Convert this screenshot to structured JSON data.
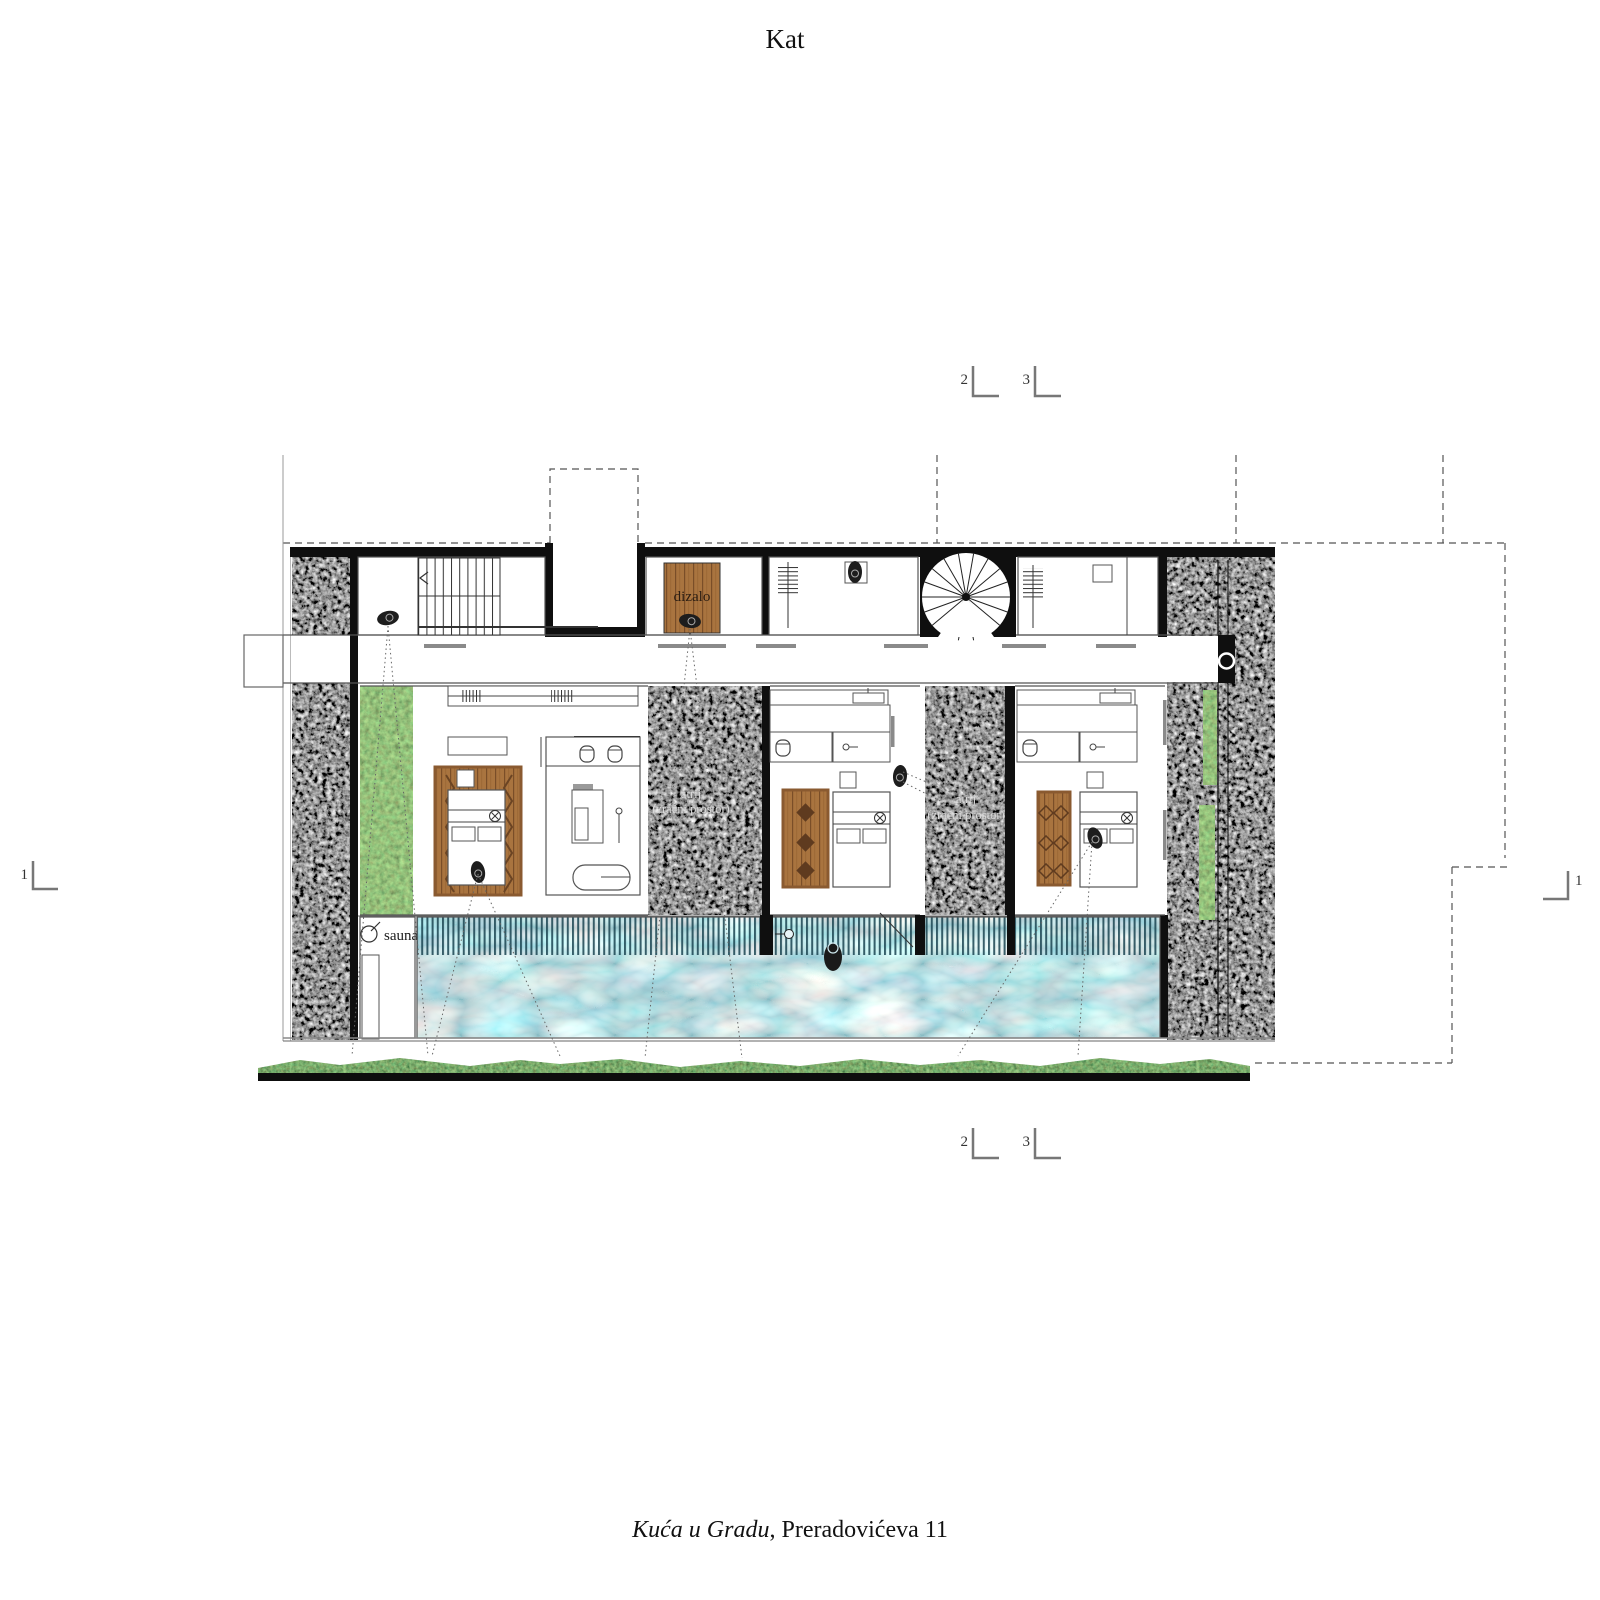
{
  "title": "Kat",
  "caption": {
    "project_name_italic": "Kuća u Gradu",
    "address": ", Preradovićeva 11"
  },
  "rooms": {
    "elevator": "dizalo",
    "sauna": "sauna"
  },
  "atrium": {
    "line1": "atrij",
    "line2": "(zračni prostor)"
  },
  "markers": {
    "m1": "1",
    "m2": "2",
    "m3": "3"
  },
  "colors": {
    "wall": "#0f0f0f",
    "gravel": "#2e2e2e",
    "grass": "#4e7a33",
    "hedge": "#31491f",
    "water": "#7fc3d2",
    "deck_slat": "#1a4451",
    "wood": "#a9743f",
    "wood_dark": "#6b4423",
    "paper": "#ffffff"
  }
}
